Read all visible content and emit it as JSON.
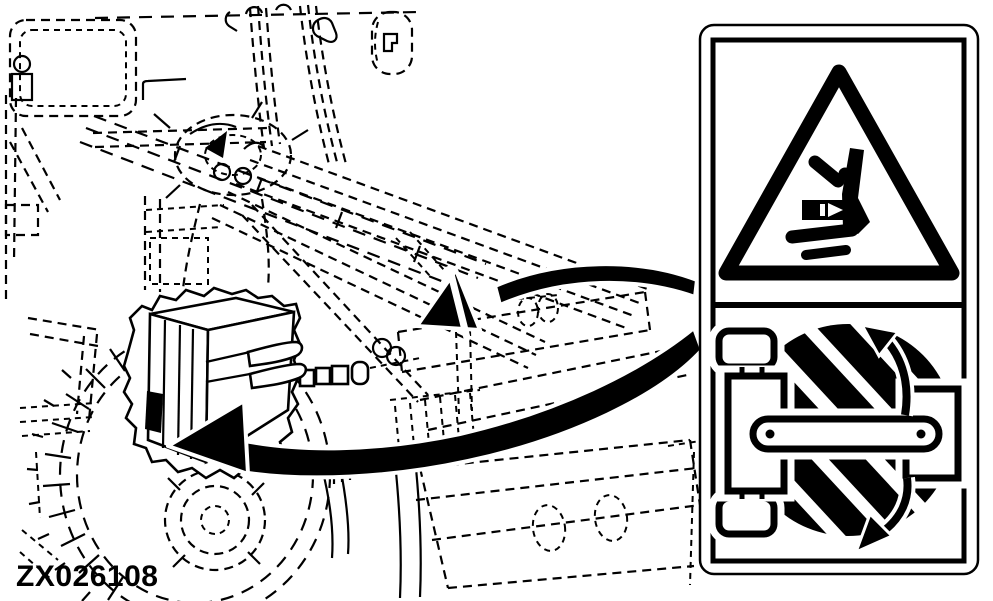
{
  "figure": {
    "code": "ZX026108"
  },
  "palette": {
    "ink": "#000000",
    "paper": "#ffffff"
  },
  "illustration": {
    "subject": "tractor-with-mid-mount-mower-phantom-outline",
    "detail": "pto-gearbox-and-driveline-yoke-solid-detail",
    "decal_location_marker": "black-rectangle-on-gearbox",
    "callouts": [
      {
        "icon": "callout-arrow-icon",
        "points_to": "frame-decal-location"
      },
      {
        "icon": "callout-arrow-icon",
        "points_to": "gearbox-decal-location"
      }
    ]
  },
  "safety_decal": {
    "top_panel": {
      "icon": "crush-hazard-warning-triangle-icon",
      "label": "crush-hazard"
    },
    "bottom_panel": {
      "icon": "rotating-driveline-icon",
      "label": "rotating-driveline-hazard"
    }
  }
}
